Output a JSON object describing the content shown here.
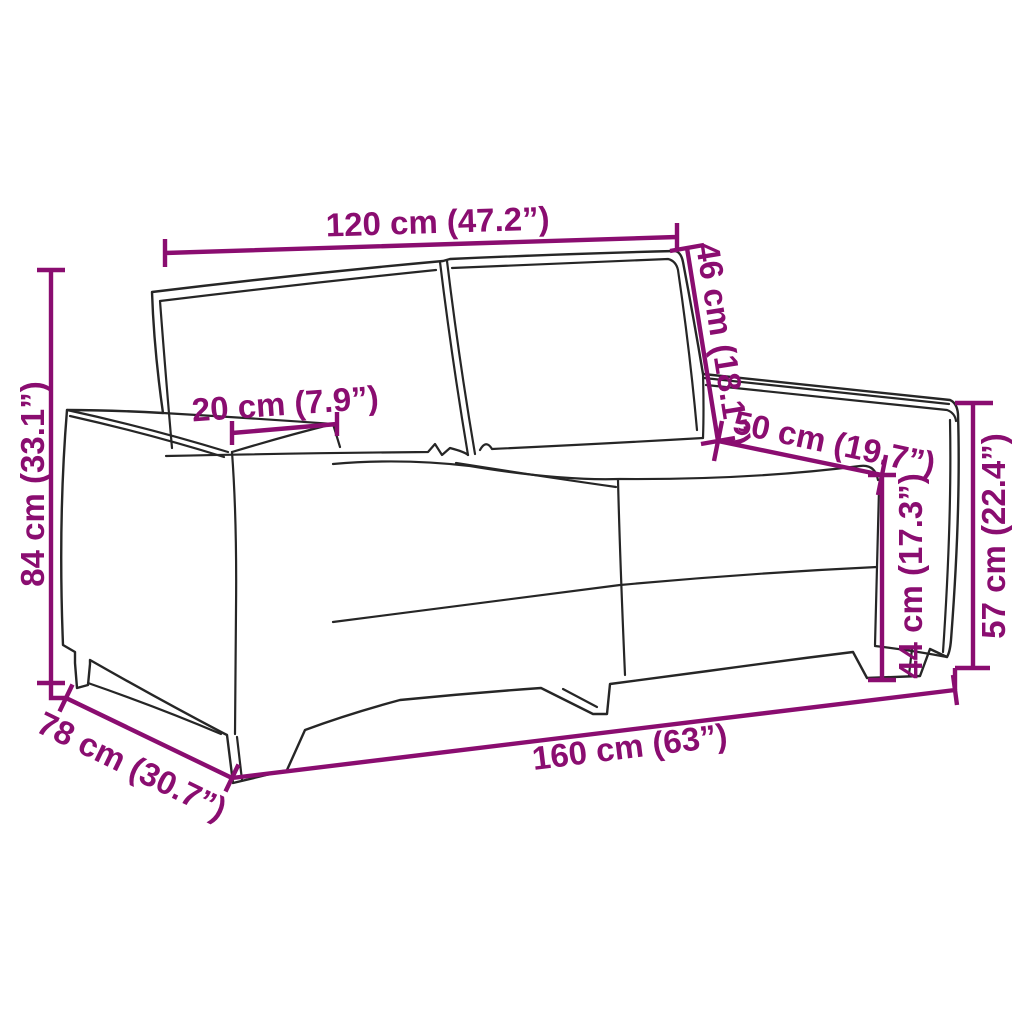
{
  "diagram": {
    "subject": "two-seater sofa dimension drawing",
    "accent_color": "#8a0d70",
    "outline_color": "#262626",
    "background_color": "#ffffff",
    "labels": {
      "seat_width": "120 cm (47.2”)",
      "back_cushion_height": "46 cm (18.1”)",
      "armrest_width": "20 cm (7.9”)",
      "seat_depth": "50 cm (19.7”)",
      "total_height": "84 cm (33.1”)",
      "seat_height": "44 cm (17.3”)",
      "armrest_height": "57 cm (22.4”)",
      "total_depth": "78 cm (30.7”)",
      "total_width": "160 cm (63”)"
    }
  }
}
